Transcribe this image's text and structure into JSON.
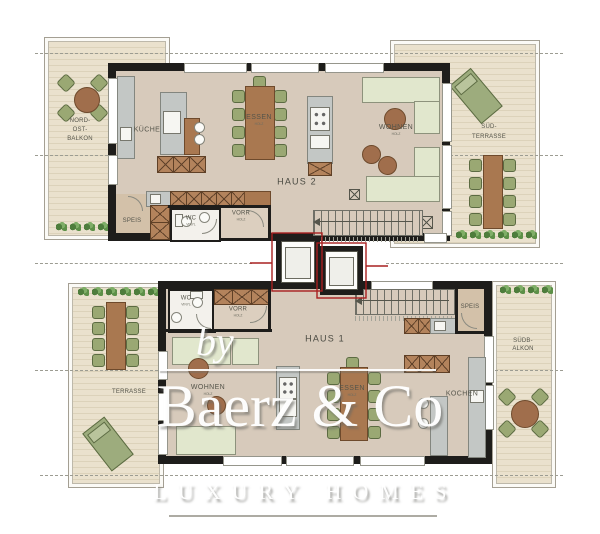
{
  "watermark": {
    "prefix": "by",
    "brand": "Baerz & Co",
    "tagline": "LUXURY HOMES"
  },
  "haus2": {
    "name": "HAUS 2",
    "balkon_label": [
      "NORD-",
      "OST-",
      "BALKON"
    ],
    "terrasse_label": [
      "SÜD-",
      "TERRASSE"
    ],
    "rooms": {
      "kueche": {
        "label": "KÜCHE"
      },
      "essen": {
        "label": "ESSEN",
        "floor": "HOLZ"
      },
      "wohnen": {
        "label": "WOHNEN",
        "floor": "HOLZ"
      },
      "speis": {
        "label": "SPEIS"
      },
      "wc": {
        "label": "WC",
        "floor": "VINYL"
      },
      "vorr": {
        "label": "VORR",
        "floor": "HOLZ"
      }
    }
  },
  "haus1": {
    "name": "HAUS 1",
    "terrasse_label": [
      "TERRASSE"
    ],
    "balkon_label": [
      "SÜDB-",
      "ALKON"
    ],
    "rooms": {
      "wohnen": {
        "label": "WOHNEN",
        "floor": "HOLZ"
      },
      "essen": {
        "label": "ESSEN",
        "floor": "HOLZ"
      },
      "kochen": {
        "label": "KOCHEN"
      },
      "speis": {
        "label": "SPEIS"
      },
      "wc": {
        "label": "WC",
        "floor": "VINYL"
      },
      "vorr": {
        "label": "VORR",
        "floor": "HOLZ"
      }
    }
  },
  "colors": {
    "wall": "#1e1d1b",
    "floor": "#d7cabb",
    "deck": "#eae1cd",
    "deck_stripe": "#dcd2ba",
    "wood": "#a97850",
    "cabinet": "#b3835c",
    "chair": "#9aa873",
    "sofa": "#e1e7cd",
    "counter": "#c3c7c5",
    "lounger": "#9dac7d",
    "plant": "#5d9048",
    "fire_line_red": "#a82020",
    "label": "#55554b",
    "watermark": "#ffffff"
  }
}
